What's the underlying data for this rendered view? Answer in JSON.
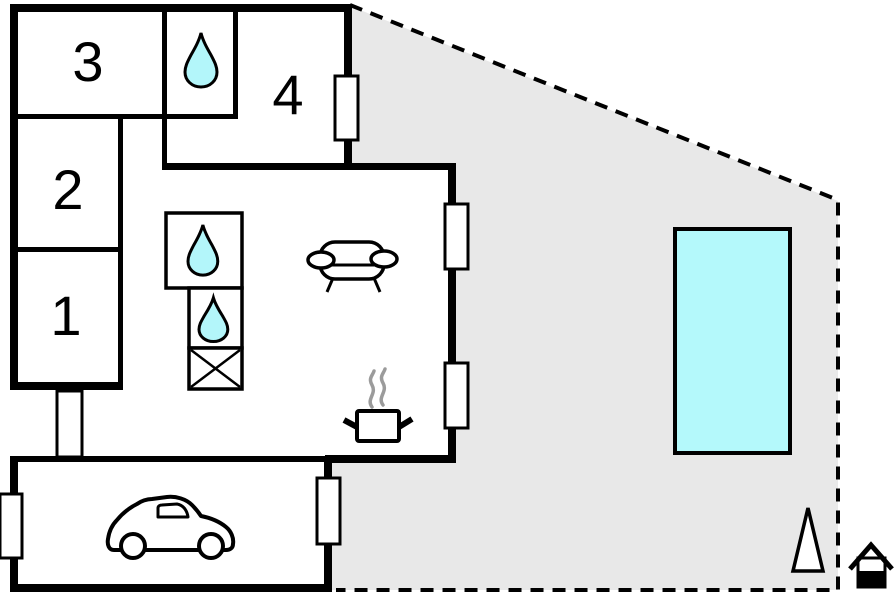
{
  "rooms": [
    {
      "label": "3"
    },
    {
      "label": "2"
    },
    {
      "label": "1"
    },
    {
      "label": "4"
    }
  ],
  "colors": {
    "wall": "#000000",
    "terrace": "#e8e8e8",
    "pool": "#b4f9fb",
    "drop": "#b3f6fa",
    "steam": "#9b9b9b",
    "background": "#ffffff"
  },
  "icons": [
    {
      "name": "water-drop-icon",
      "count": 3
    },
    {
      "name": "crossed-box-icon",
      "count": 1
    },
    {
      "name": "sofa-icon",
      "count": 1
    },
    {
      "name": "cooking-pot-icon",
      "count": 1
    },
    {
      "name": "car-icon",
      "count": 1
    },
    {
      "name": "swimming-pool",
      "count": 1
    },
    {
      "name": "tree-icon",
      "count": 1
    },
    {
      "name": "house-marker-icon",
      "count": 1
    }
  ],
  "counts": {
    "windows": 5,
    "doors": 1
  }
}
